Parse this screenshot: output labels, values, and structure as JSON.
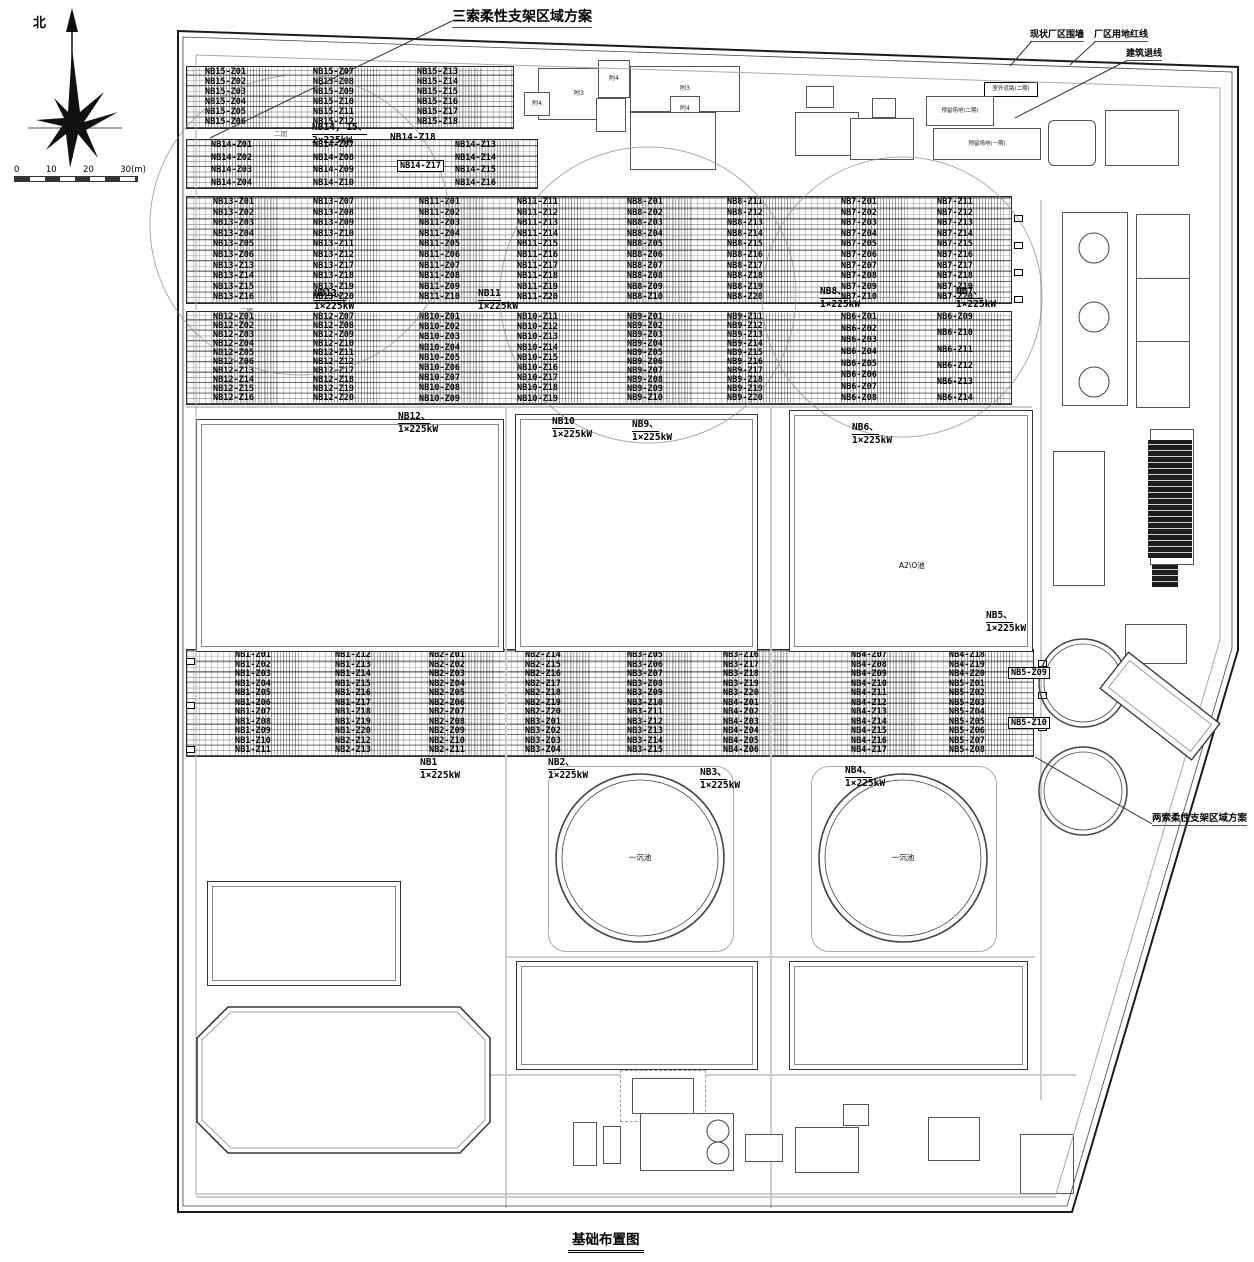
{
  "annotations": {
    "three_cable": "三索柔性支架区域方案",
    "two_cable": "两索柔性支架区域方案",
    "existing_wall": "现状厂区围墙",
    "land_red_line": "厂区用地红线",
    "building_setback": "建筑退线",
    "north": "北",
    "phase_mark": "二期",
    "title": "基础布置图"
  },
  "scale": {
    "t0": "0",
    "t1": "10",
    "t2": "20",
    "t3": "30(m)"
  },
  "inverters": [
    {
      "name": "NB14, 15、",
      "power": "2×225kW"
    },
    {
      "name": "NB13、",
      "power": "1×225kW"
    },
    {
      "name": "NB11",
      "power": "1×225kW"
    },
    {
      "name": "NB8、",
      "power": "1×225kW"
    },
    {
      "name": "NB7、",
      "power": "1×225kW"
    },
    {
      "name": "NB12、",
      "power": "1×225kW"
    },
    {
      "name": "NB10",
      "power": "1×225kW"
    },
    {
      "name": "NB9、",
      "power": "1×225kW"
    },
    {
      "name": "NB6、",
      "power": "1×225kW"
    },
    {
      "name": "NB5、",
      "power": "1×225kW"
    },
    {
      "name": "NB1",
      "power": "1×225kW"
    },
    {
      "name": "NB2、",
      "power": "1×225kW"
    },
    {
      "name": "NB3、",
      "power": "1×225kW"
    },
    {
      "name": "NB4、",
      "power": "1×225kW"
    }
  ],
  "arrays": {
    "nb15": {
      "c1": [
        "NB15-Z01",
        "NB15-Z02",
        "NB15-Z03",
        "NB15-Z04",
        "NB15-Z05",
        "NB15-Z06"
      ],
      "c2": [
        "NB15-Z07",
        "NB15-Z08",
        "NB15-Z09",
        "NB15-Z10",
        "NB15-Z11",
        "NB15-Z12"
      ],
      "c3": [
        "NB15-Z13",
        "NB15-Z14",
        "NB15-Z15",
        "NB15-Z16",
        "NB15-Z17",
        "NB15-Z18"
      ]
    },
    "nb14": {
      "c1": [
        "NB14-Z01",
        "NB14-Z02",
        "NB14-Z03",
        "NB14-Z04"
      ],
      "c2": [
        "NB14-Z07",
        "NB14-Z08",
        "NB14-Z09",
        "NB14-Z10"
      ],
      "c3": [
        "NB14-Z13",
        "NB14-Z14",
        "NB14-Z15",
        "NB14-Z16"
      ],
      "callout_plain": "NB14-Z18",
      "callout_boxed": "NB14-Z17"
    },
    "nb13": {
      "c1": [
        "NB13-Z01",
        "NB13-Z02",
        "NB13-Z03",
        "NB13-Z04",
        "NB13-Z05",
        "NB13-Z06",
        "NB13-Z13",
        "NB13-Z14",
        "NB13-Z15",
        "NB13-Z16"
      ],
      "c2": [
        "NB13-Z07",
        "NB13-Z08",
        "NB13-Z09",
        "NB13-Z10",
        "NB13-Z11",
        "NB13-Z12",
        "NB13-Z17",
        "NB13-Z18",
        "NB13-Z19",
        "NB13-Z20"
      ]
    },
    "nb11": {
      "c1": [
        "NB11-Z01",
        "NB11-Z02",
        "NB11-Z03",
        "NB11-Z04",
        "NB11-Z05",
        "NB11-Z06",
        "NB11-Z07",
        "NB11-Z08",
        "NB11-Z09",
        "NB11-Z10"
      ],
      "c2": [
        "NB11-Z11",
        "NB11-Z12",
        "NB11-Z13",
        "NB11-Z14",
        "NB11-Z15",
        "NB11-Z16",
        "NB11-Z17",
        "NB11-Z18",
        "NB11-Z19",
        "NB11-Z20"
      ]
    },
    "nb8": {
      "c1": [
        "NB8-Z01",
        "NB8-Z02",
        "NB8-Z03",
        "NB8-Z04",
        "NB8-Z05",
        "NB8-Z06",
        "NB8-Z07",
        "NB8-Z08",
        "NB8-Z09",
        "NB8-Z10"
      ],
      "c2": [
        "NB8-Z11",
        "NB8-Z12",
        "NB8-Z13",
        "NB8-Z14",
        "NB8-Z15",
        "NB8-Z16",
        "NB8-Z17",
        "NB8-Z18",
        "NB8-Z19",
        "NB8-Z20"
      ]
    },
    "nb7": {
      "c1": [
        "NB7-Z01",
        "NB7-Z02",
        "NB7-Z03",
        "NB7-Z04",
        "NB7-Z05",
        "NB7-Z06",
        "NB7-Z07",
        "NB7-Z08",
        "NB7-Z09",
        "NB7-Z10"
      ],
      "c2": [
        "NB7-Z11",
        "NB7-Z12",
        "NB7-Z13",
        "NB7-Z14",
        "NB7-Z15",
        "NB7-Z16",
        "NB7-Z17",
        "NB7-Z18",
        "NB7-Z19",
        "NB7-Z20"
      ]
    },
    "nb12": {
      "c1": [
        "NB12-Z01",
        "NB12-Z02",
        "NB12-Z03",
        "NB12-Z04",
        "NB12-Z05",
        "NB12-Z06",
        "NB12-Z13",
        "NB12-Z14",
        "NB12-Z15",
        "NB12-Z16"
      ],
      "c2": [
        "NB12-Z07",
        "NB12-Z08",
        "NB12-Z09",
        "NB12-Z10",
        "NB12-Z11",
        "NB12-Z12",
        "NB12-Z17",
        "NB12-Z18",
        "NB12-Z19",
        "NB12-Z20"
      ]
    },
    "nb10": {
      "c1": [
        "NB10-Z01",
        "NB10-Z02",
        "NB10-Z03",
        "NB10-Z04",
        "NB10-Z05",
        "NB10-Z06",
        "NB10-Z07",
        "NB10-Z08",
        "NB10-Z09"
      ],
      "c2": [
        "NB10-Z11",
        "NB10-Z12",
        "NB10-Z13",
        "NB10-Z14",
        "NB10-Z15",
        "NB10-Z16",
        "NB10-Z17",
        "NB10-Z18",
        "NB10-Z19"
      ]
    },
    "nb9": {
      "c1": [
        "NB9-Z01",
        "NB9-Z02",
        "NB9-Z03",
        "NB9-Z04",
        "NB9-Z05",
        "NB9-Z06",
        "NB9-Z07",
        "NB9-Z08",
        "NB9-Z09",
        "NB9-Z10"
      ],
      "c2": [
        "NB9-Z11",
        "NB9-Z12",
        "NB9-Z13",
        "NB9-Z14",
        "NB9-Z15",
        "NB9-Z16",
        "NB9-Z17",
        "NB9-Z18",
        "NB9-Z19",
        "NB9-Z20"
      ]
    },
    "nb6": {
      "c1": [
        "NB6-Z01",
        "NB6-Z02",
        "NB6-Z03",
        "NB6-Z04",
        "NB6-Z05",
        "NB6-Z06",
        "NB6-Z07",
        "NB6-Z08"
      ],
      "c2": [
        "NB6-Z09",
        "NB6-Z10",
        "NB6-Z11",
        "NB6-Z12",
        "NB6-Z13",
        "NB6-Z14"
      ]
    },
    "nb1": {
      "c1": [
        "NB1-Z01",
        "NB1-Z02",
        "NB1-Z03",
        "NB1-Z04",
        "NB1-Z05",
        "NB1-Z06",
        "NB1-Z07",
        "NB1-Z08",
        "NB1-Z09",
        "NB1-Z10",
        "NB1-Z11"
      ],
      "c2": [
        "NB1-Z12",
        "NB1-Z13",
        "NB1-Z14",
        "NB1-Z15",
        "NB1-Z16",
        "NB1-Z17",
        "NB1-Z18",
        "NB1-Z19",
        "NB1-Z20",
        "NB2-Z12",
        "NB2-Z13"
      ]
    },
    "nb2": {
      "c1": [
        "NB2-Z01",
        "NB2-Z02",
        "NB2-Z03",
        "NB2-Z04",
        "NB2-Z05",
        "NB2-Z06",
        "NB2-Z07",
        "NB2-Z08",
        "NB2-Z09",
        "NB2-Z10",
        "NB2-Z11"
      ],
      "c2": [
        "NB2-Z14",
        "NB2-Z15",
        "NB2-Z16",
        "NB2-Z17",
        "NB2-Z18",
        "NB2-Z19",
        "NB2-Z20",
        "NB3-Z01",
        "NB3-Z02",
        "NB3-Z03",
        "NB3-Z04"
      ]
    },
    "nb3": {
      "c1": [
        "NB3-Z05",
        "NB3-Z06",
        "NB3-Z07",
        "NB3-Z08",
        "NB3-Z09",
        "NB3-Z10",
        "NB3-Z11",
        "NB3-Z12",
        "NB3-Z13",
        "NB3-Z14",
        "NB3-Z15"
      ],
      "c2": [
        "NB3-Z16",
        "NB3-Z17",
        "NB3-Z18",
        "NB3-Z19",
        "NB3-Z20",
        "NB4-Z01",
        "NB4-Z02",
        "NB4-Z03",
        "NB4-Z04",
        "NB4-Z05",
        "NB4-Z06"
      ]
    },
    "nb4": {
      "c1": [
        "NB4-Z07",
        "NB4-Z08",
        "NB4-Z09",
        "NB4-Z10",
        "NB4-Z11",
        "NB4-Z12",
        "NB4-Z13",
        "NB4-Z14",
        "NB4-Z15",
        "NB4-Z16",
        "NB4-Z17"
      ],
      "c2": [
        "NB4-Z18",
        "NB4-Z19",
        "NB4-Z20",
        "NB5-Z01",
        "NB5-Z02",
        "NB5-Z03",
        "NB5-Z04",
        "NB5-Z05",
        "NB5-Z06",
        "NB5-Z07",
        "NB5-Z08"
      ]
    },
    "nb5": {
      "callout1": "NB5-Z09",
      "callout2": "NB5-Z10"
    }
  },
  "buildings": {
    "fu3": "附3",
    "fu4": "附4",
    "phase2_road": "室外道路(二期)",
    "phase2_area": "预留场地(二期)",
    "phase1_area": "预留场地(一期)",
    "a2o_basin": "A2\\O池",
    "primary_clarifier": "一沉池"
  }
}
